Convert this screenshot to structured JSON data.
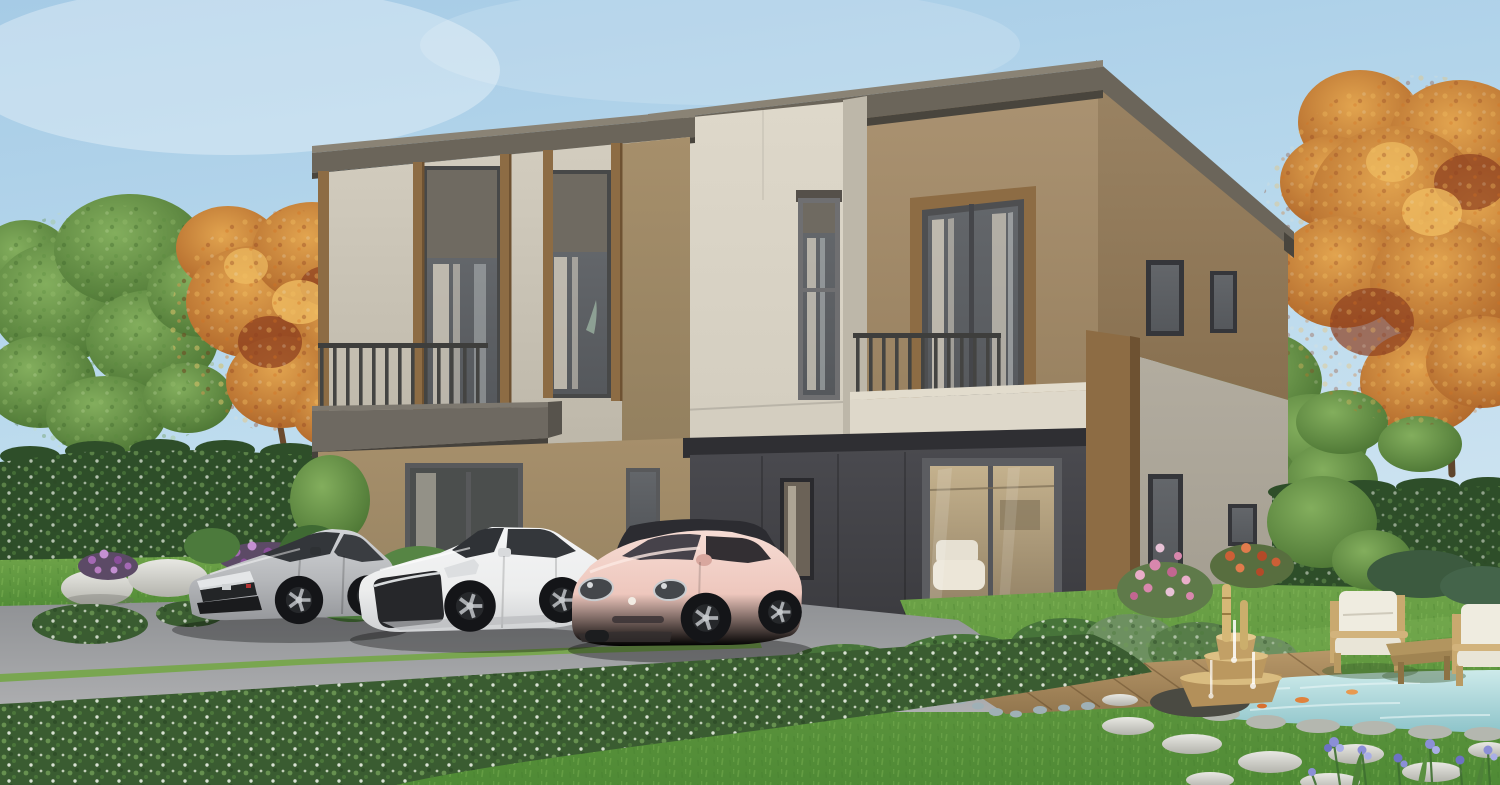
{
  "scene": {
    "type": "architectural-rendering",
    "description": "Daytime 3D render of a modern two-storey duplex home with flat sloped roof, cream and tan cladding with wood trim, two balconies, charcoal ground floor with glass sliding door, three parked cars (silver hatchback, white sedan, pink hatchback with black roof), driveway with flowering hedge, lawn, garden with koi pond, bamboo fountain, stepping stones, outdoor wooden chairs, and green and autumn trees",
    "objects": [
      "sky",
      "green-tree-left",
      "autumn-tree-left",
      "autumn-tree-right",
      "hedge-wall-left",
      "hedge-wall-right",
      "duplex-house",
      "roof-fascia",
      "upper-floor-windows",
      "balcony-left",
      "balcony-right",
      "balcony-door",
      "ground-floor-dark-wall",
      "sliding-glass-door",
      "wood-corner-pillar",
      "silver-hatchback",
      "white-sedan",
      "pink-hatchback",
      "driveway",
      "grass-strip",
      "flowering-hedge",
      "lawn",
      "white-rocks",
      "purple-flowers",
      "pink-flowers",
      "red-flowers",
      "garden-shrubs",
      "wood-deck-path",
      "bamboo-fountain",
      "koi-pond",
      "stepping-stones",
      "outdoor-chair-1",
      "outdoor-chair-2",
      "coffee-table",
      "iris-flowers"
    ]
  },
  "colors": {
    "sky_top": "#a6cbe6",
    "sky_mid": "#badaed",
    "sky_horizon": "#d6e7f2",
    "roof": "#6b655a",
    "roof_light": "#8a8375",
    "roof_shadow": "#49453d",
    "wall_cream": "#d3cdbf",
    "wall_cream_dark": "#bdb7a9",
    "wall_cream_bright": "#ded8ca",
    "wall_tan": "#ab9372",
    "wall_tan_dark": "#97805f",
    "wall_tan_side": "#9a8363",
    "wall_tan_side_dark": "#887050",
    "wall_khaki": "#a68f6b",
    "wall_khaki_dark": "#93805f",
    "wall_greige": "#b3ada0",
    "wall_greige_dark": "#a29c8f",
    "wall_dark": "#4a4a4f",
    "wall_dark_deep": "#39393d",
    "wood_trim": "#8d6c44",
    "wood_dark": "#6e5232",
    "window_frame": "#45464a",
    "glass": "#55585c",
    "blind": "#6f6a61",
    "curtain": "#ddd6c6",
    "railing": "#3e3e3c",
    "driveway_far": "#8e9093",
    "driveway_near": "#aeafb1",
    "grass_strip": "#79a650",
    "lawn_light": "#6fa449",
    "lawn_dark": "#4f8a35",
    "hedge": "#3a5c31",
    "hedge_wall": "#2e4e29",
    "tree_green_light": "#83ae5d",
    "tree_green_dark": "#466f2f",
    "tree_autumn_light": "#e2a44f",
    "tree_autumn_dark": "#a75c24",
    "tree_autumn_red": "#8d3f1f",
    "rock_light": "#e8e8e3",
    "rock_dark": "#b3b3ac",
    "flower_purple": "#a469b4",
    "flower_pink": "#de93b5",
    "flower_red": "#cc5f36",
    "flower_iris": "#8b8fd6",
    "water_light": "#cdeaea",
    "water_deep": "#8cc3c9",
    "stone": "#bdc0b8",
    "deck": "#ab8e60",
    "car_silver": "#b6b8bb",
    "car_white": "#eceded",
    "car_pink": "#eec7bd",
    "car_glass": "#33363a",
    "car_roof": "#2c2c31",
    "interior_warm": "#c4b18d",
    "cushion": "#efece0",
    "chair_wood": "#c9a96f"
  }
}
